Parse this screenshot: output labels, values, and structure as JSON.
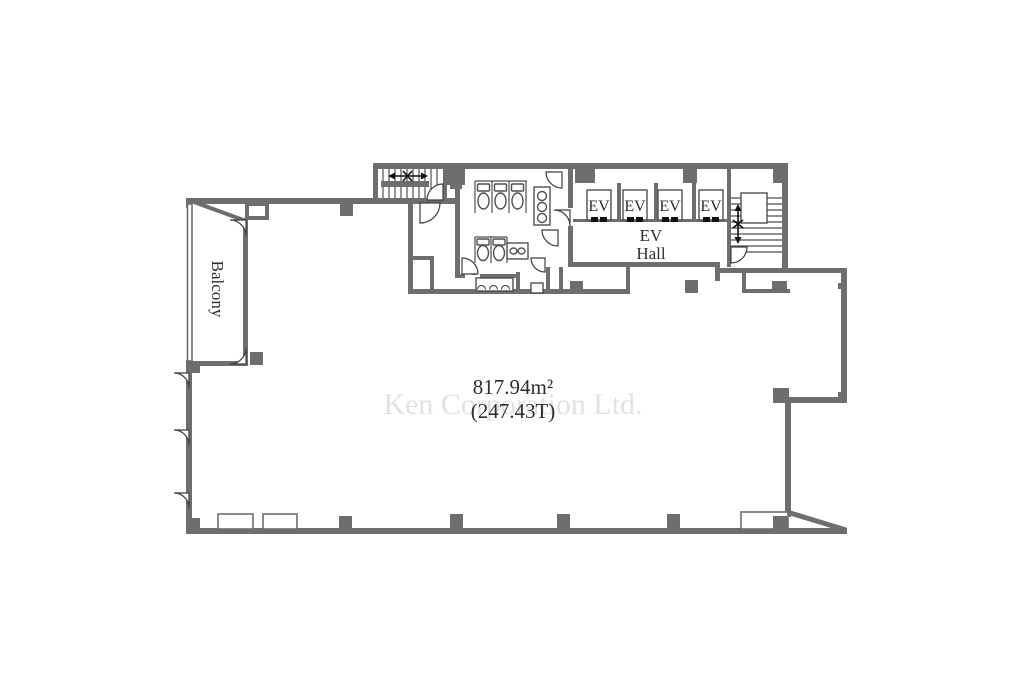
{
  "floor_plan": {
    "watermark": "Ken Corporation Ltd.",
    "balcony": {
      "label": "Balcony"
    },
    "area": {
      "sqm": "817.94m²",
      "tsubo": "(247.43T)"
    },
    "ev_hall": {
      "line1": "EV",
      "line2": "Hall"
    },
    "elevators": [
      {
        "label": "EV"
      },
      {
        "label": "EV"
      },
      {
        "label": "EV"
      },
      {
        "label": "EV"
      }
    ],
    "colors": {
      "wall": "#6e6e6e",
      "fixture": "#4f4f4f",
      "door_arc": "#3f3f3f",
      "arrow": "#111111",
      "text": "#2e2e2e",
      "watermark": "#e2e2e2",
      "background": "#ffffff"
    }
  }
}
